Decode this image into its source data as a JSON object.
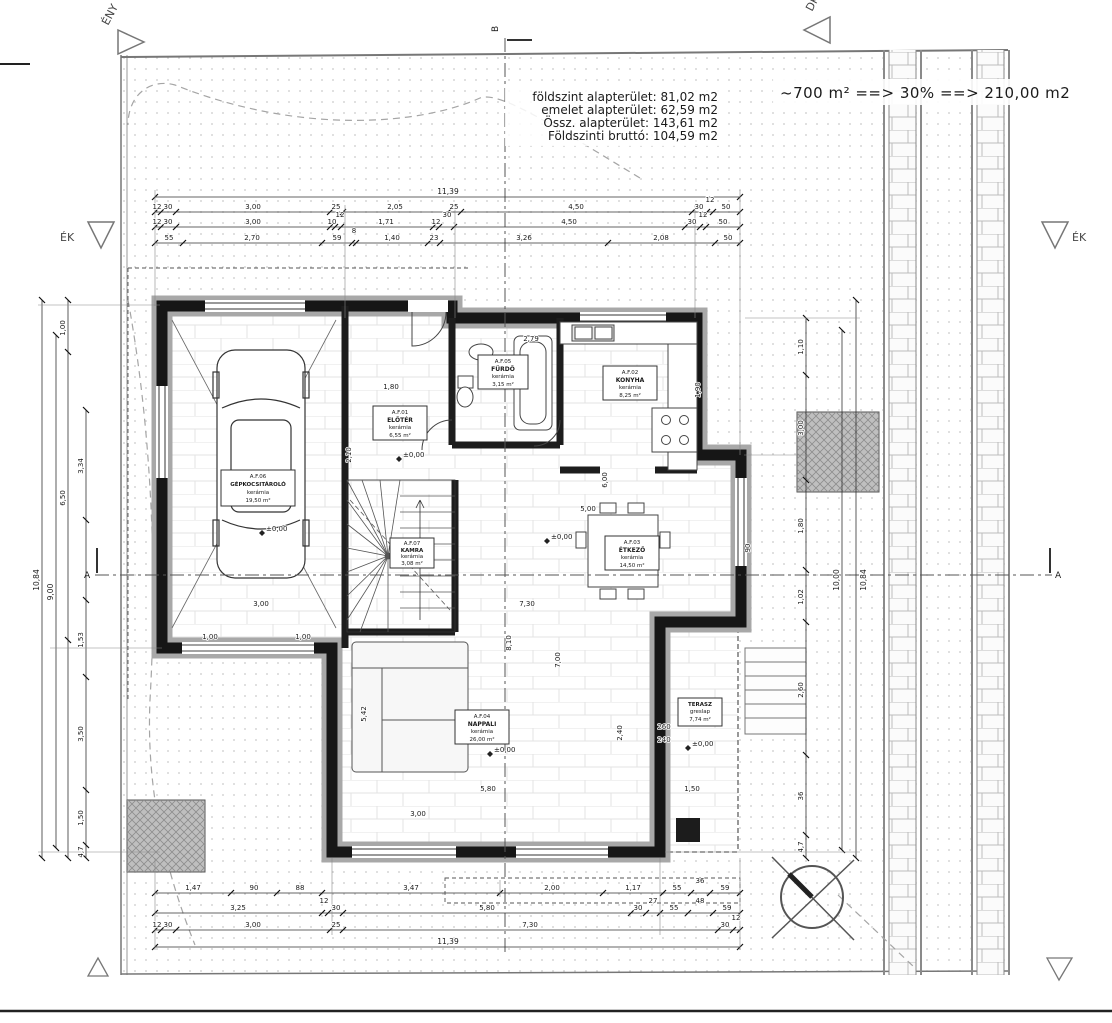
{
  "header": {
    "area_lines": [
      "földszint alapterület: 81,02 m2",
      "emelet alapterület: 62,59 m2",
      "Össz. alapterület: 143,61 m2",
      "Földszinti bruttó: 104,59 m2"
    ],
    "coverage_formula": "~700 m² ==> 30% ==> 210,00 m2"
  },
  "orientation": {
    "top_left": "ÉNY",
    "top_right": "DK",
    "left": "ÉK",
    "right": "ÉK"
  },
  "section_marks": {
    "a": "A",
    "b": "B"
  },
  "levels": {
    "zero": "±0,00"
  },
  "rooms": {
    "eloter": {
      "code": "A.F.01",
      "name": "ELŐTÉR",
      "finish": "kerámia",
      "area": "6,55 m²"
    },
    "konyha": {
      "code": "A.F.02",
      "name": "KONYHA",
      "finish": "kerámia",
      "area": "8,25 m²"
    },
    "etkezo": {
      "code": "A.F.03",
      "name": "ÉTKEZŐ",
      "finish": "kerámia",
      "area": "14,50 m²"
    },
    "nappali": {
      "code": "A.F.04",
      "name": "NAPPALI",
      "finish": "kerámia",
      "area": "26,00 m²"
    },
    "furdo": {
      "code": "A.F.05",
      "name": "FÜRDŐ",
      "finish": "kerámia",
      "area": "3,15 m²"
    },
    "gepkocsitarolo": {
      "code": "A.F.06",
      "name": "GÉPKOCSITÁROLÓ",
      "finish": "kerámia",
      "area": "19,50 m²"
    },
    "kamra": {
      "code": "A.F.07",
      "name": "KAMRA",
      "finish": "kerámia",
      "area": "3,08 m²"
    },
    "terasz": {
      "name": "TERASZ",
      "finish": "greslap",
      "area": "7,74 m²"
    }
  },
  "dims": {
    "top_overall": "11,39",
    "bottom_overall": "11,39",
    "top_row1": [
      "12",
      "30",
      "3,00",
      "25",
      "2,05",
      "25",
      "4,50",
      "30",
      "12",
      "50"
    ],
    "top_row2": [
      "12",
      "30",
      "3,00",
      "10",
      "12",
      "1,71",
      "12",
      "30",
      "4,50",
      "30",
      "12",
      "50"
    ],
    "top_row3": [
      "55",
      "2,70",
      "59",
      "8",
      "1,40",
      "23",
      "3,26",
      "2,08",
      "50"
    ],
    "bottom_row1": [
      "1,47",
      "90",
      "88",
      "3,47",
      "2,00",
      "1,17",
      "55",
      "36",
      "59"
    ],
    "bottom_row2": [
      "3,25",
      "12",
      "30",
      "5,80",
      "30",
      "27",
      "55",
      "48",
      "59"
    ],
    "bottom_row3": [
      "12",
      "30",
      "3,00",
      "25",
      "7,30",
      "30",
      "12"
    ],
    "left": [
      "10,84",
      "9,00",
      "1,00",
      "6,50",
      "3,34",
      "1,53",
      "3,50",
      "1,50",
      "4,7"
    ],
    "right": [
      "10,84",
      "10,00",
      "1,10",
      "3,00",
      "1,80",
      "1,02",
      "2,60",
      "36",
      "4,7"
    ],
    "interior": [
      "2,79",
      "1,80",
      "2,10",
      "6,00",
      "5,00",
      "7,30",
      "8,10",
      "7,00",
      "5,42",
      "5,80",
      "3,00",
      "3,00",
      "1,50",
      "2,40",
      "260",
      "240",
      "90",
      "1,00",
      "1,00",
      "1,90"
    ]
  }
}
